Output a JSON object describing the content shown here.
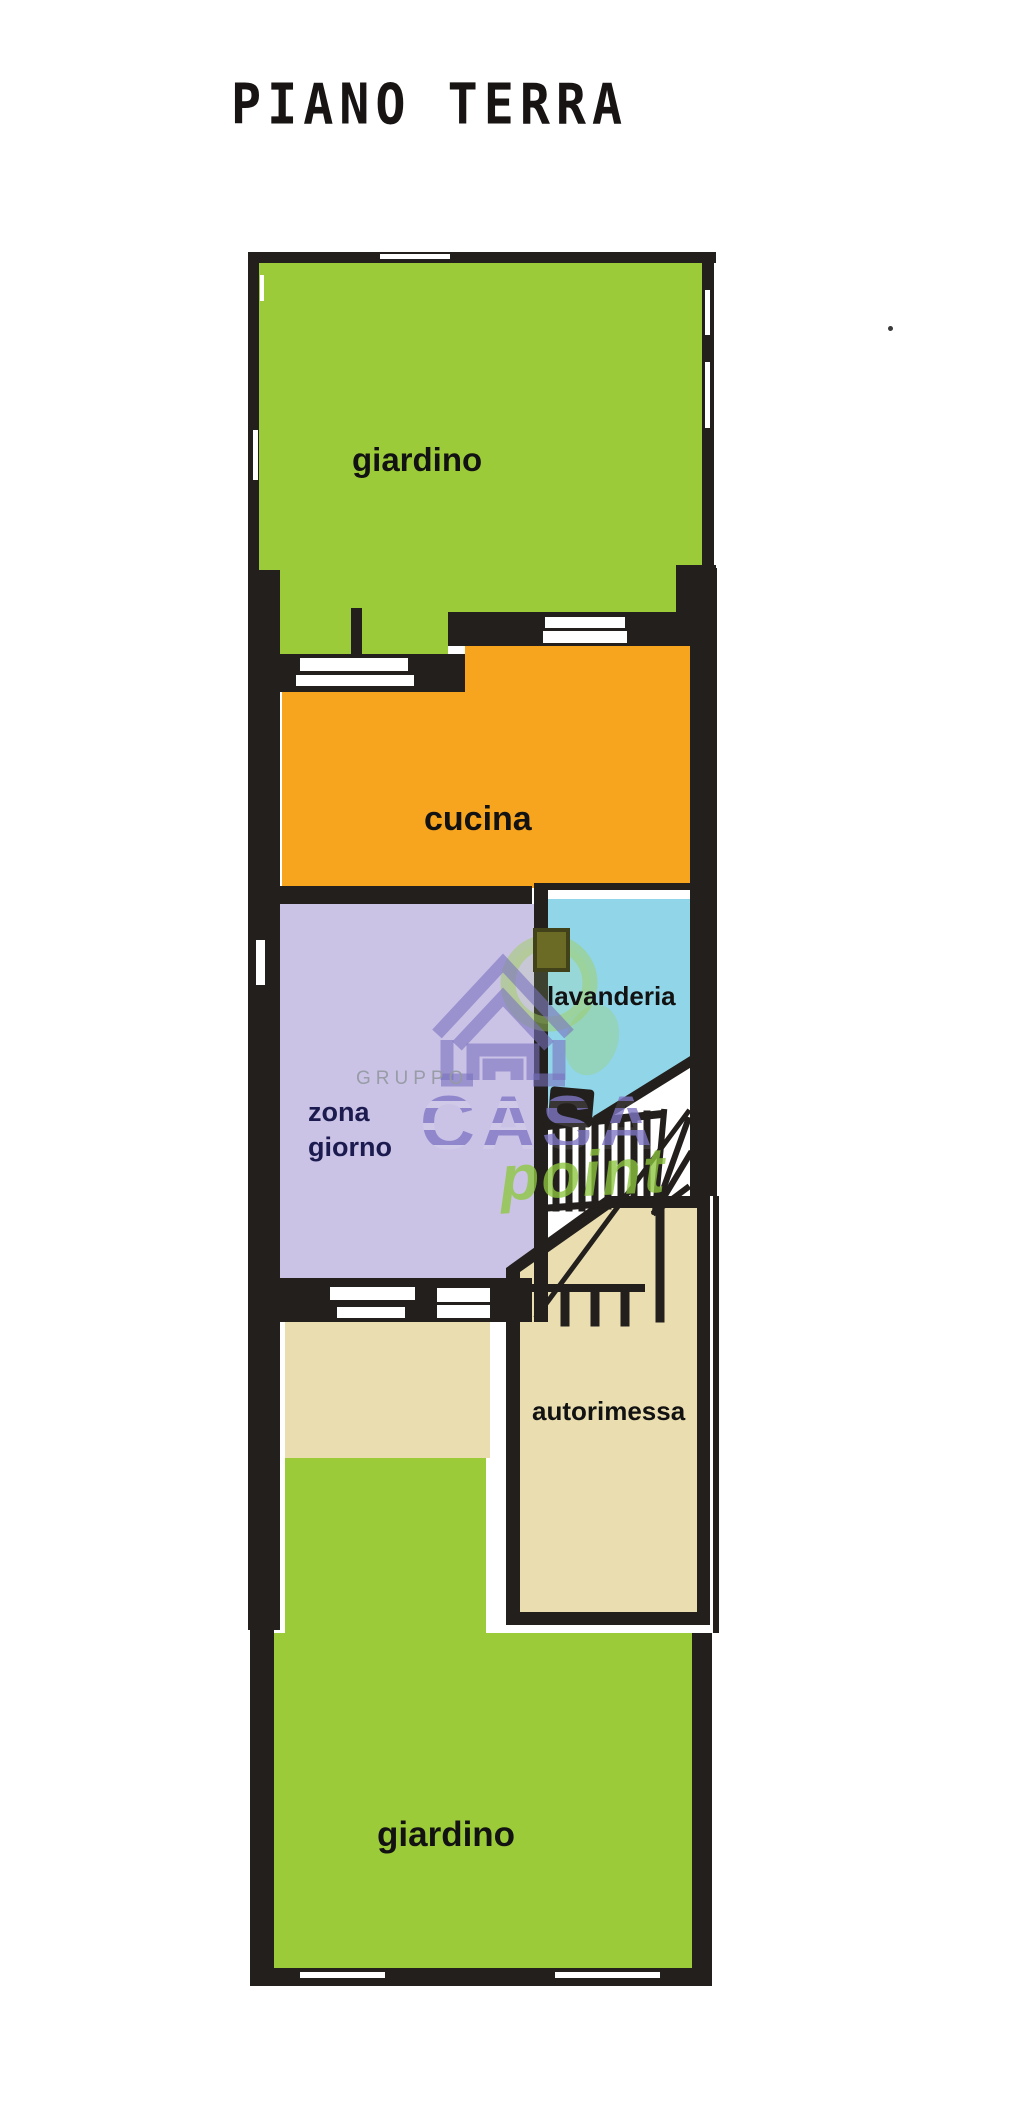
{
  "title": "PIANO TERRA",
  "rooms": {
    "garden_top": "giardino",
    "kitchen": "cucina",
    "living_line1": "zona",
    "living_line2": "giorno",
    "laundry": "lavanderia",
    "garage": "autorimessa",
    "garden_bottom": "giardino"
  },
  "watermark": {
    "line1": "GRUPPO",
    "line2": "CASA",
    "line3": "point"
  },
  "colors": {
    "paper": "#ffffff",
    "wall": "#221f1d",
    "garden": "#9ccb3a",
    "kitchen": "#f7a51e",
    "living": "#cbc3e6",
    "laundry": "#90d6e8",
    "garage": "#eadeb0",
    "door_white": "#ffffff",
    "chimney": "#6b6b26",
    "chimney_border": "#42421a",
    "label_text": "#121212",
    "living_text": "#1b1b4f",
    "watermark_purple": "#8077c5",
    "watermark_green": "#8dc63f",
    "watermark_gray": "#949aa2"
  }
}
